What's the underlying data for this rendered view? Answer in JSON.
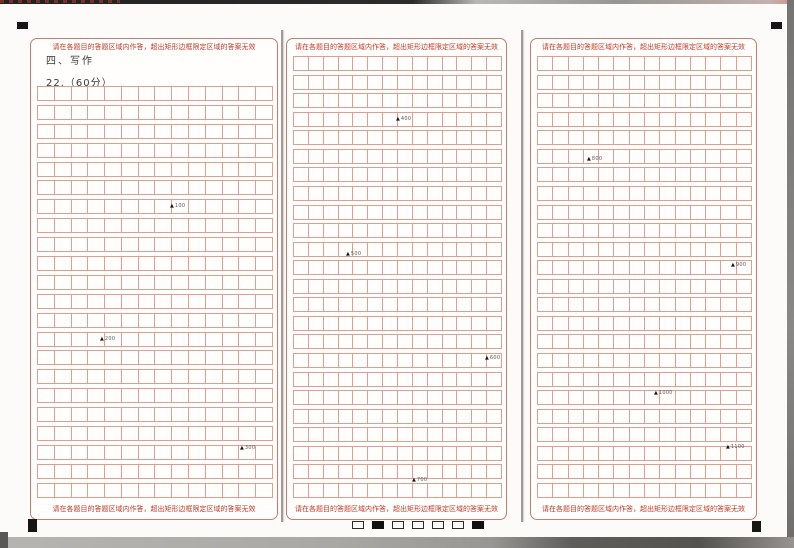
{
  "document": {
    "instruction_top": "请在各题目的答题区域内作答，超出矩形边框限定区域的答案无效",
    "instruction_bottom": "请在各题目的答题区域内作答，超出矩形边框限定区域的答案无效",
    "section_title": "四、写作",
    "question_label": "22.（60分）"
  },
  "grid": {
    "marker_symbol": "▲",
    "columns": [
      {
        "name": "left",
        "rows": 22,
        "cols": 14
      },
      {
        "name": "middle",
        "rows": 24,
        "cols": 14
      },
      {
        "name": "right",
        "rows": 24,
        "cols": 14
      }
    ],
    "word_count_markers": [
      {
        "label": "100",
        "x": 170,
        "y": 203
      },
      {
        "label": "200",
        "x": 100,
        "y": 336
      },
      {
        "label": "300",
        "x": 240,
        "y": 445
      },
      {
        "label": "400",
        "x": 396,
        "y": 116
      },
      {
        "label": "500",
        "x": 346,
        "y": 251
      },
      {
        "label": "600",
        "x": 485,
        "y": 355
      },
      {
        "label": "700",
        "x": 412,
        "y": 477
      },
      {
        "label": "800",
        "x": 587,
        "y": 156
      },
      {
        "label": "900",
        "x": 731,
        "y": 262
      },
      {
        "label": "1000",
        "x": 654,
        "y": 390
      },
      {
        "label": "1100",
        "x": 726,
        "y": 444
      }
    ]
  },
  "footer": {
    "sync_marks": [
      0,
      1,
      0,
      0,
      0,
      0,
      1
    ]
  },
  "colors": {
    "grid_line": "#dc9f92",
    "region_border": "#c57d6f",
    "instruction_text": "#c03a28",
    "header_text": "#3b3b3b",
    "marker_text": "#333333"
  }
}
